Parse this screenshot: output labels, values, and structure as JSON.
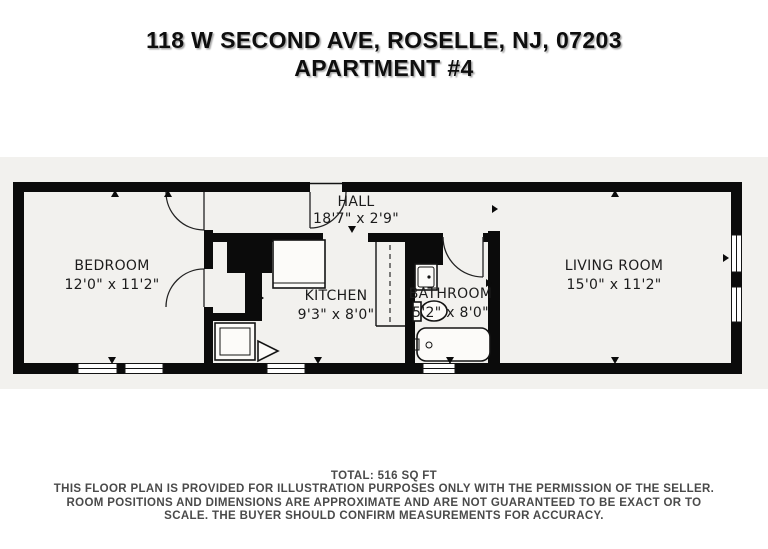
{
  "title": {
    "line1": "118 W SECOND AVE, ROSELLE, NJ, 07203",
    "line2": "APARTMENT #4"
  },
  "rooms": [
    {
      "id": "bedroom",
      "name": "BEDROOM",
      "dimensions": "12'0\" x 11'2\""
    },
    {
      "id": "hall",
      "name": "HALL",
      "dimensions": "18'7\" x 2'9\""
    },
    {
      "id": "kitchen",
      "name": "KITCHEN",
      "dimensions": "9'3\" x 8'0\""
    },
    {
      "id": "bathroom",
      "name": "BATHROOM",
      "dimensions": "5'2\" x 8'0\""
    },
    {
      "id": "living_room",
      "name": "LIVING ROOM",
      "dimensions": "15'0\" x 11'2\""
    }
  ],
  "footer": {
    "total": "TOTAL: 516 SQ FT",
    "disclaimer": "THIS FLOOR PLAN IS PROVIDED FOR ILLUSTRATION PURPOSES ONLY WITH THE PERMISSION OF THE SELLER. ROOM POSITIONS AND DIMENSIONS ARE APPROXIMATE AND ARE NOT GUARANTEED TO BE EXACT OR TO SCALE. THE BUYER SHOULD CONFIRM MEASUREMENTS FOR ACCURACY."
  },
  "fixtures": [
    "entry-door",
    "bedroom-door",
    "bedroom-closet-door",
    "bathroom-door",
    "closet-hanging-rod",
    "kitchen-counter",
    "kitchen-stove",
    "kitchen-cabinet-door",
    "bathroom-sink",
    "toilet",
    "bathtub",
    "window-bedroom-1",
    "window-bedroom-2",
    "window-kitchen",
    "window-bathroom",
    "window-living-1",
    "window-living-2"
  ],
  "colors": {
    "wall": "#0b0b0b",
    "floor": "#f2f1ee",
    "background": "#ffffff",
    "text": "#1c1c1c",
    "footer_text": "#4a4a4a"
  }
}
